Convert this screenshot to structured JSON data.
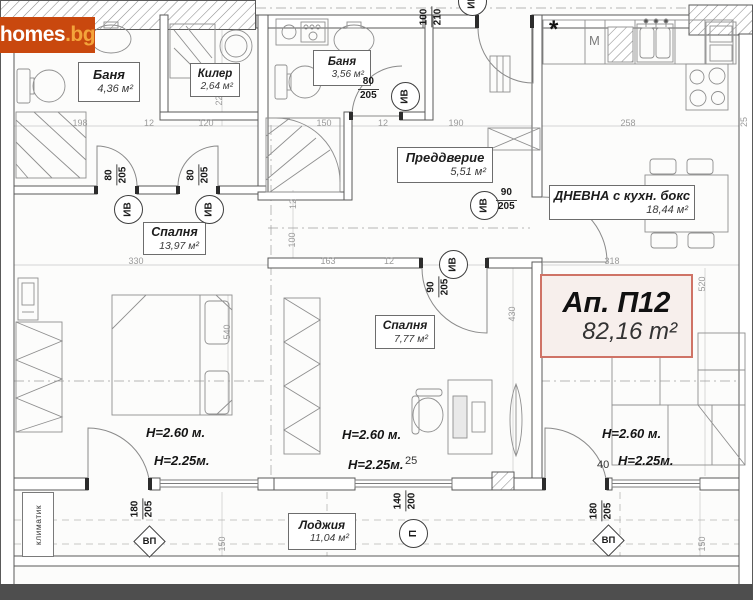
{
  "watermark": {
    "brand": "homes",
    "suffix": ".bg"
  },
  "apartment": {
    "title": "Ап. П12",
    "area": "82,16 m²"
  },
  "rooms": {
    "bath1": {
      "name": "Баня",
      "area": "4,36 м²"
    },
    "closet": {
      "name": "Килер",
      "area": "2,64 м²"
    },
    "bath2": {
      "name": "Баня",
      "area": "3,56 м²"
    },
    "hall": {
      "name": "Преддверие",
      "area": "5,51 м²"
    },
    "living": {
      "name": "ДНЕВНА с кухн. бокс",
      "area": "18,44 м²"
    },
    "bed1": {
      "name": "Спалня",
      "area": "13,97 м²"
    },
    "bed2": {
      "name": "Спалня",
      "area": "7,77 м²"
    },
    "loggia": {
      "name": "Лоджия",
      "area": "11,04 м²"
    }
  },
  "heights": {
    "ceiling": "Н=2.60 м.",
    "soffit": "Н=2.25м."
  },
  "door_tags": {
    "iv": "ИВ",
    "bed1_door1": {
      "w": "80",
      "h": "205"
    },
    "bed1_door2": {
      "w": "80",
      "h": "205"
    },
    "bath2_door": {
      "w": "80",
      "h": "205"
    },
    "bed2_door": {
      "w": "90",
      "h": "205"
    },
    "living_door": {
      "w": "90",
      "h": "205"
    },
    "entrance_door": {
      "w": "100",
      "h": "210"
    }
  },
  "window_tags": {
    "vp": "ВП",
    "p": "П",
    "left_balcony_door": {
      "w": "180",
      "h": "205"
    },
    "center_window": {
      "w": "140",
      "h": "200"
    },
    "right_balcony_door": {
      "w": "180",
      "h": "205"
    }
  },
  "kitchen": {
    "star": "*",
    "m_label": "M"
  },
  "annotations": {
    "klimatik": "климатик"
  },
  "dimensions": {
    "top_row": [
      "198",
      "12",
      "120",
      "150",
      "12",
      "190",
      "258"
    ],
    "mid_row": [
      "330",
      "163",
      "12",
      "318"
    ],
    "v220": "220",
    "v540": "540",
    "v100": "100",
    "v12": "12",
    "v430": "430",
    "v520": "520",
    "v150_left": "150",
    "v150_right": "150",
    "v25": "25",
    "n25": "25",
    "n40": "40"
  }
}
